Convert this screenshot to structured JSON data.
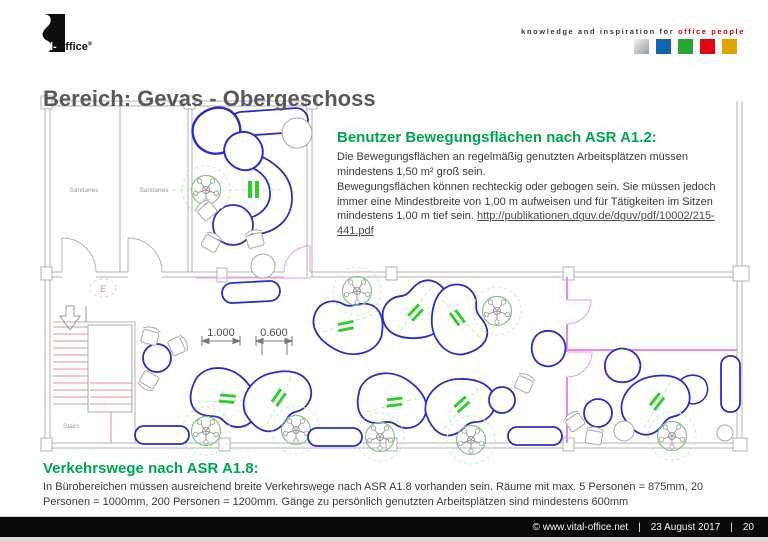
{
  "header": {
    "logo": {
      "brand_white": "Vital-",
      "brand_black": "Office",
      "registered": "®"
    },
    "tagline": {
      "prefix": "knowledge and inspiration for ",
      "highlight": "office people"
    },
    "square_colors": [
      "#c0c0c0-silver-gradient",
      "#1466aa",
      "#2aa337",
      "#e20613",
      "#dea500"
    ]
  },
  "title": "Bereich: Gevas - Obergeschoss",
  "info_box": {
    "heading": "Benutzer Bewegungsflächen nach ASR A1.2:",
    "para1": "Die Bewegungsflächen an regelmäßig genutzten Arbeitsplätzen müssen mindestens 1,50 m² groß sein.",
    "para2": "Bewegungsflächen können rechteckig oder gebogen sein. Sie müssen jedoch immer eine Mindestbreite von 1,00 m aufweisen und für Tätigkeiten im Sitzen mindestens 1,00 m tief sein. ",
    "link": "http://publikationen.dguv.de/dguv/pdf/10002/215-441.pdf"
  },
  "verkehrswege": {
    "heading": "Verkehrswege nach ASR A1.8:",
    "body": "In Bürobereichen müssen ausreichend breite Verkehrswege nach ASR A1.8 vorhanden sein. Räume mit max. 5 Personen = 875mm, 20 Personen = 1000mm, 200 Personen = 1200mm. Gänge zu persönlich genutzten Arbeitsplätzen sind mindestens 600mm"
  },
  "floor_plan": {
    "labels": {
      "sanitaries1": "Sanitaries",
      "sanitaries2": "Sanitaries",
      "stairs": "Stairs",
      "exit": "E",
      "dim1": "1.000",
      "dim2": "0.600"
    }
  },
  "footer": {
    "copyright": "©  www.vital-office.net",
    "sep1": "|",
    "date": "23 August 2017",
    "sep2": "|",
    "page": "20"
  },
  "colors": {
    "accent_green": "#00a551",
    "title_gray": "#595959",
    "brand_red": "#cc0010",
    "wall_gray": "#b3b3b3",
    "furniture_blue": "#2b2bcc",
    "partition_magenta": "#ee85ee",
    "stairs_red": "#e89090",
    "footer_black": "#0a0a0a"
  }
}
